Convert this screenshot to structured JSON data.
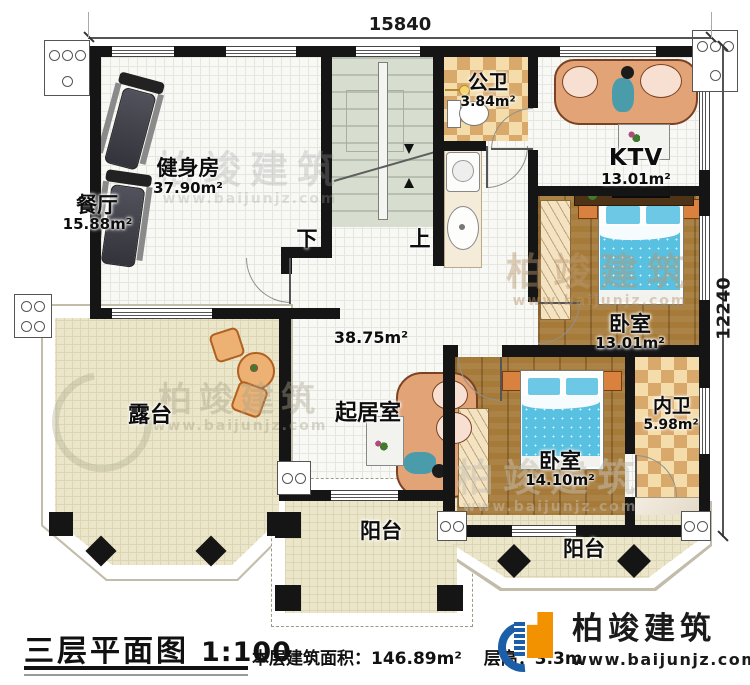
{
  "title_block": {
    "title": "三层平面图",
    "scale": "1:100",
    "area_label": "本层建筑面积：",
    "area_value": "146.89m²",
    "height_label": "层高：",
    "height_value": "3.3m"
  },
  "dimensions": {
    "top": "15840",
    "right": "12240"
  },
  "stairs": {
    "down": "下",
    "up": "上"
  },
  "rooms": [
    {
      "name": "健身房",
      "area": "37.90m²"
    },
    {
      "name": "餐厅",
      "area": "15.88m²"
    },
    {
      "name": "公卫",
      "area": "3.84m²"
    },
    {
      "name": "KTV",
      "area": "13.01m²"
    },
    {
      "name": "卧室",
      "area": "13.01m²"
    },
    {
      "name": "卧室",
      "area": "14.10m²"
    },
    {
      "name": "内卫",
      "area": "5.98m²"
    },
    {
      "name": "起居室",
      "area": "38.75m²"
    },
    {
      "name": "露台",
      "area": ""
    },
    {
      "name": "阳台",
      "area": ""
    },
    {
      "name": "阳台",
      "area": ""
    }
  ],
  "brand": {
    "name": "柏竣建筑",
    "url": "www.baijunjz.com"
  },
  "colors": {
    "wall": "#151515",
    "wood": "#a67a38",
    "tile": "#d9a96c",
    "bed": "#5cc3e2",
    "logo_blue": "#1c5fa8",
    "logo_orange": "#f39200"
  }
}
